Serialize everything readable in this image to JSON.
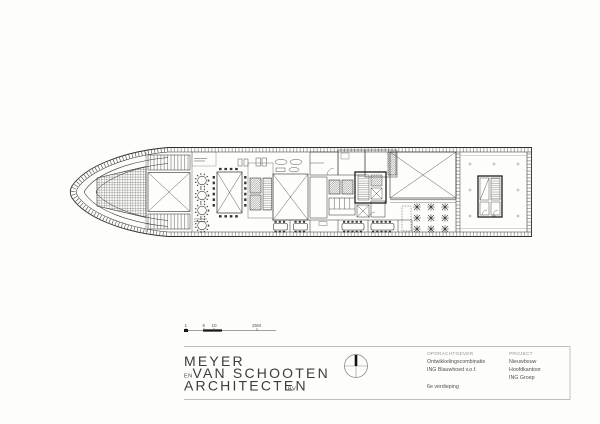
{
  "colors": {
    "paper": "#fdfdfb",
    "ink": "#2e2e2e",
    "light_ink": "#989898"
  },
  "scalebar": {
    "labels": [
      "1",
      "5",
      "10",
      "25M"
    ]
  },
  "titleblock": {
    "logo": {
      "line1": "MEYER",
      "en": "EN",
      "line2": "VAN SCHOOTEN",
      "line3": "ARCHITECTEN",
      "bv": "BV"
    },
    "client": {
      "label": "OPDRACHTGEVER",
      "line1": "Ontwikkelingscombinatie",
      "line2": "ING Blauwhoed v.o.f.",
      "floor": "6e verdieping"
    },
    "project": {
      "label": "PROJECT",
      "line1": "Nieuwbouw",
      "line2": "Hoofdkantoor",
      "line3": "ING Groep"
    }
  }
}
